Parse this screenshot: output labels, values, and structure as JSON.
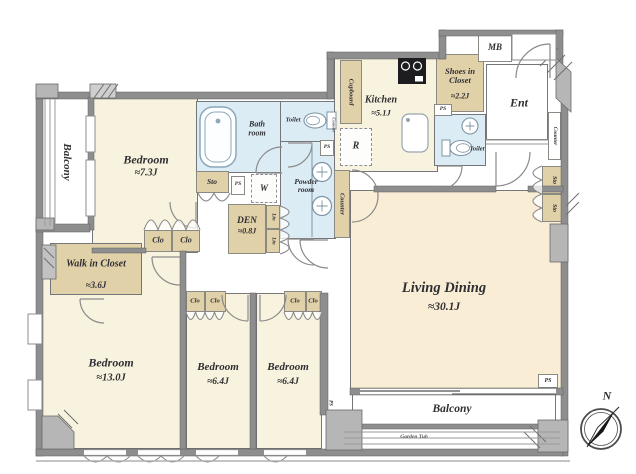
{
  "plan": {
    "rooms": {
      "living": {
        "name": "Living Dining",
        "area": "≈30.1J"
      },
      "bedroom_73": {
        "name": "Bedroom",
        "area": "≈7.3J"
      },
      "bedroom_130": {
        "name": "Bedroom",
        "area": "≈13.0J"
      },
      "bedroom_64a": {
        "name": "Bedroom",
        "area": "≈6.4J"
      },
      "bedroom_64b": {
        "name": "Bedroom",
        "area": "≈6.4J"
      },
      "kitchen": {
        "name": "Kitchen",
        "area": "≈5.1J"
      },
      "den": {
        "name": "DEN",
        "area": "≈0.8J"
      },
      "walk_in_closet": {
        "name": "Walk in Closet",
        "area": "≈3.6J"
      },
      "shoes_in_closet": {
        "name": "Shoes in Closet",
        "area": "≈2.2J"
      },
      "bath": {
        "name": "Bath room"
      },
      "powder": {
        "name": "Powder room"
      },
      "toilet": {
        "name": "Toilet"
      },
      "entrance": {
        "name": "Ent"
      },
      "balcony": {
        "name": "Balcony"
      }
    },
    "labels": {
      "mb": "MB",
      "refrigerator": "R",
      "washer": "W",
      "cupboard": "Cupboard",
      "counter": "Counter",
      "sto": "Sto",
      "clo": "Clo",
      "lin": "Lin",
      "ps": "PS",
      "garden": "Garden Tub",
      "north": "N"
    },
    "colors": {
      "bedroom_floor": "#f8f3de",
      "living_floor": "#f9edd6",
      "closet_tan": "#e1d1a9",
      "wet_area_blue": "#dcecf5",
      "wall_gray": "#8e8e8e"
    }
  }
}
